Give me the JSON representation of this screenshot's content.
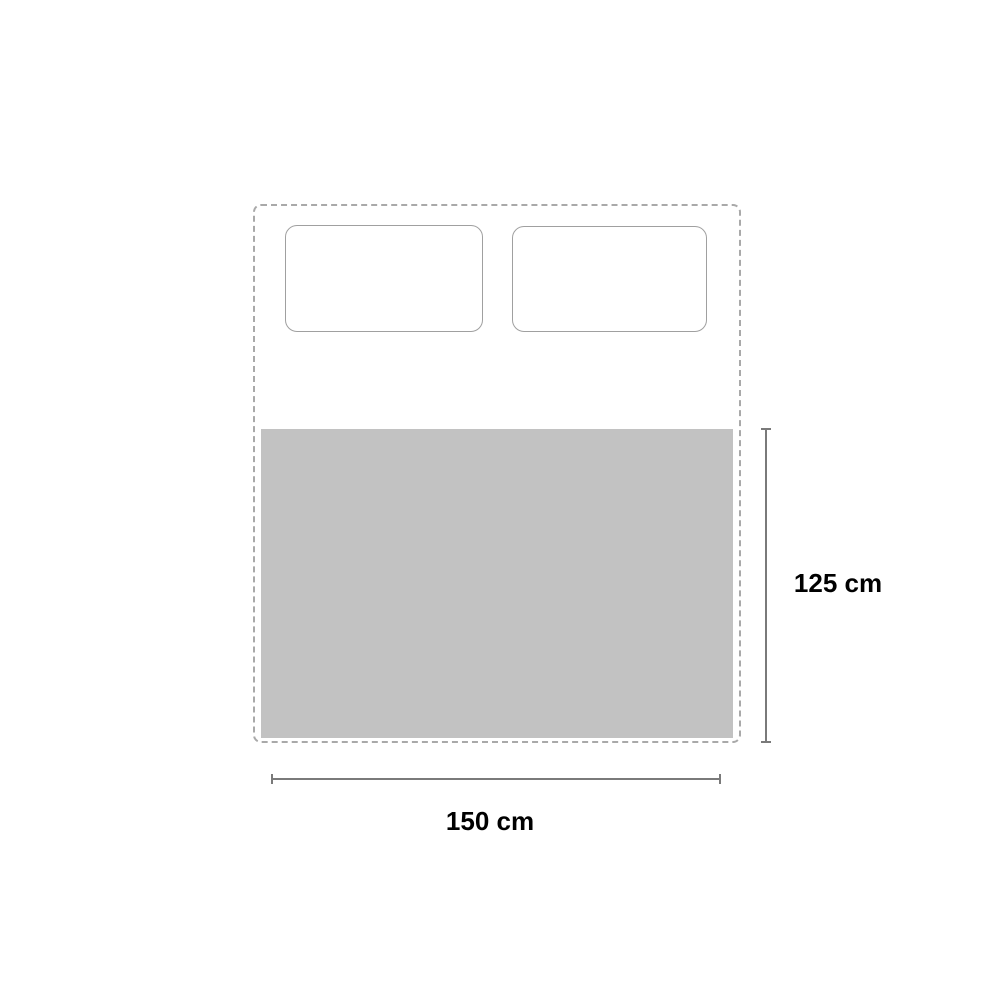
{
  "diagram": {
    "kind": "product-dimension-diagram",
    "subject": "bed-top-view-with-blanket",
    "bed": {
      "name": "bed-outline",
      "style": "dashed"
    },
    "pillows": [
      {
        "name": "pillow-left"
      },
      {
        "name": "pillow-right"
      }
    ],
    "blanket": {
      "name": "blanket"
    },
    "dimensions": {
      "height": {
        "label": "125 cm",
        "orientation": "vertical",
        "measures": "blanket height"
      },
      "width": {
        "label": "150 cm",
        "orientation": "horizontal",
        "measures": "blanket width"
      }
    },
    "colors": {
      "background": "#ffffff",
      "blanket_fill": "#c2c2c2",
      "bed_outline": "#a9a9a9",
      "pillow_outline": "#a0a0a0",
      "dimension_line": "#7a7a7a",
      "label_text": "#000000"
    }
  }
}
